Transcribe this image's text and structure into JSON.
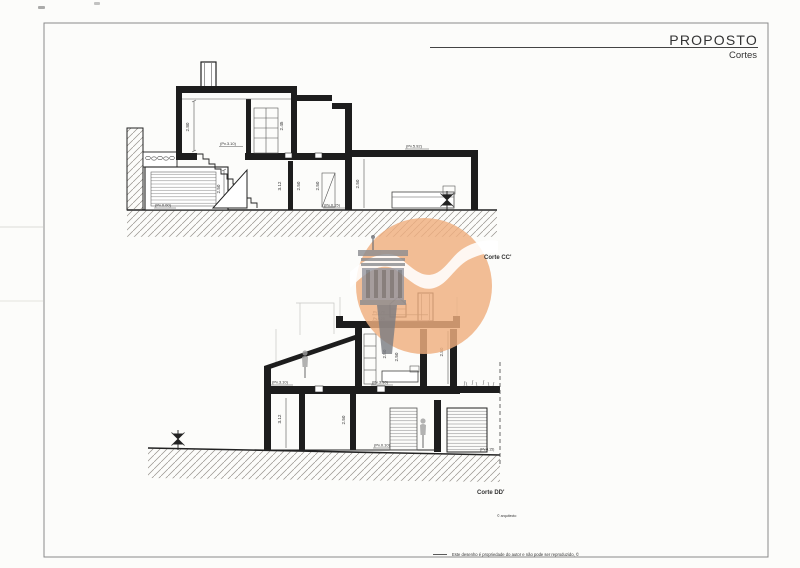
{
  "header": {
    "title": "PROPOSTO",
    "subtitle": "Cortes"
  },
  "sections": {
    "corte_cc": {
      "label": "Corte CC'",
      "dims": {
        "room_main": "2.80",
        "room_upper_right": "2.45",
        "garage": "2.50",
        "room_g1": "3.12",
        "room_g2": "2.50",
        "room_g3": "2.50",
        "room_wing": "2.50"
      },
      "levels": {
        "upper_floor": "(Pv.3.10)",
        "wing_roof": "(Pv.5.92)",
        "ground_left": "(Pv.0.00)",
        "ground_mid": "(Pv.0.15)"
      }
    },
    "corte_dd": {
      "label": "Corte DD'",
      "dims": {
        "room_u1": "2.50",
        "room_u2": "2.50",
        "room_u3": "2.80",
        "room_g1": "3.12",
        "room_g2": "2.50"
      },
      "levels": {
        "roof_a": "Pv.6.70",
        "roof_b": "Pv.6.25",
        "upper_left": "(Pv.3.10)",
        "upper_mid": "(Pv.3.10)",
        "ground_mid": "(Pv.0.10)",
        "ground_right": "(Pv.0.15)"
      }
    }
  },
  "footer": {
    "architect_credit": "© arquitecto",
    "copyright_note": "Este desenho é propriedade do autor e não pode ser reproduzido, ©"
  },
  "watermark": {
    "icon": "column-logo-icon",
    "circle_color": "#efae7f",
    "band_color": "#ffffff",
    "column_color": "#8b8c90"
  }
}
